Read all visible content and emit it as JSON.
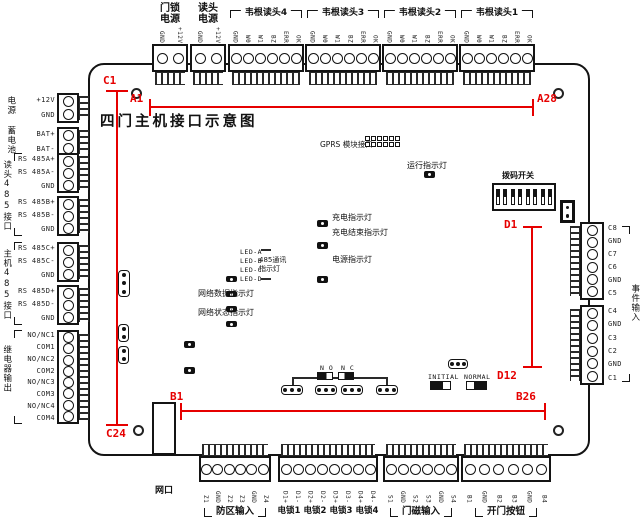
{
  "title": "四门主机接口示意图",
  "red_labels": {
    "a1": "A1",
    "a28": "A28",
    "b1": "B1",
    "b26": "B26",
    "c1": "C1",
    "c24": "C24",
    "d1": "D1",
    "d12": "D12"
  },
  "colors": {
    "annotation": "#e60000",
    "line": "#141414"
  },
  "top": {
    "lock_power": {
      "line1": "门锁",
      "line2": "电源",
      "pins": [
        "GND",
        "+12V"
      ]
    },
    "reader_power": {
      "line1": "读头",
      "line2": "电源",
      "pins": [
        "GND",
        "+12V"
      ]
    },
    "wiegand4": {
      "label": "韦根读头4",
      "pins": [
        "GND",
        "W0",
        "W1",
        "BZ",
        "ERR",
        "OK"
      ]
    },
    "wiegand3": {
      "label": "韦根读头3",
      "pins": [
        "GND",
        "W0",
        "W1",
        "BZ",
        "ERR",
        "OK"
      ]
    },
    "wiegand2": {
      "label": "韦根读头2",
      "pins": [
        "GND",
        "W0",
        "W1",
        "BZ",
        "ERR",
        "OK"
      ]
    },
    "wiegand1": {
      "label": "韦根读头1",
      "pins": [
        "GND",
        "W0",
        "W1",
        "BZ",
        "ERR",
        "OK"
      ]
    }
  },
  "left": {
    "power": {
      "label": "电源",
      "pins": [
        "+12V",
        "GND"
      ]
    },
    "battery": {
      "label": "蓄电池",
      "pins": [
        "BAT+",
        "BAT-"
      ]
    },
    "reader485": {
      "label": "读头485接口",
      "block_a": [
        "RS 485A+",
        "RS 485A-",
        "GND"
      ],
      "block_b": [
        "RS 485B+",
        "RS 485B-",
        "GND"
      ]
    },
    "host485": {
      "label": "主机485接口",
      "block_c": [
        "RS 485C+",
        "RS 485C-",
        "GND"
      ],
      "block_d": [
        "RS 485D+",
        "RS 485D-",
        "GND"
      ]
    },
    "relay": {
      "label": "继电器输出",
      "pins": [
        "NO/NC1",
        "COM1",
        "NO/NC2",
        "COM2",
        "NO/NC3",
        "COM3",
        "NO/NC4",
        "COM4"
      ]
    }
  },
  "right": {
    "label": "事件输入",
    "block1": [
      "C8",
      "GND",
      "C7",
      "C6",
      "GND",
      "C5"
    ],
    "block2": [
      "C4",
      "GND",
      "C3",
      "C2",
      "GND",
      "C1"
    ]
  },
  "bottom": {
    "lan": {
      "label": "网口"
    },
    "zone": {
      "label": "防区输入",
      "pins": [
        "Z1",
        "GND",
        "Z2",
        "Z3",
        "GND",
        "Z4"
      ]
    },
    "locks": {
      "labels": [
        "电锁1",
        "电锁2",
        "电锁3",
        "电锁4"
      ],
      "pins": [
        "D1+",
        "D1-",
        "D2+",
        "D2-",
        "D3+",
        "D3-",
        "D4+",
        "D4-"
      ]
    },
    "door_sensor": {
      "label": "门磁输入",
      "pins": [
        "S1",
        "GND",
        "S2",
        "S3",
        "GND",
        "S4"
      ]
    },
    "exit_button": {
      "label": "开门按钮",
      "pins": [
        "B1",
        "GND",
        "B2",
        "B3",
        "GND",
        "B4"
      ]
    }
  },
  "board": {
    "gprs_label": "GPRS 模块接口",
    "run_led": "运行指示灯",
    "charge_led": "充电指示灯",
    "charge_done_led": "充电结束指示灯",
    "power_led": "电源指示灯",
    "comm_leds": {
      "items": [
        "LED-A",
        "LED-B",
        "LED-C",
        "LED-D"
      ],
      "label1": "485通讯",
      "label2": "指示灯"
    },
    "net_data_led": "网络数据指示灯",
    "net_status_led": "网络状态指示灯",
    "dip_label": "拨码开关",
    "jumper_no": "N O",
    "jumper_nc": "N C",
    "initial": "INITIAL",
    "normal": "NORMAL"
  }
}
